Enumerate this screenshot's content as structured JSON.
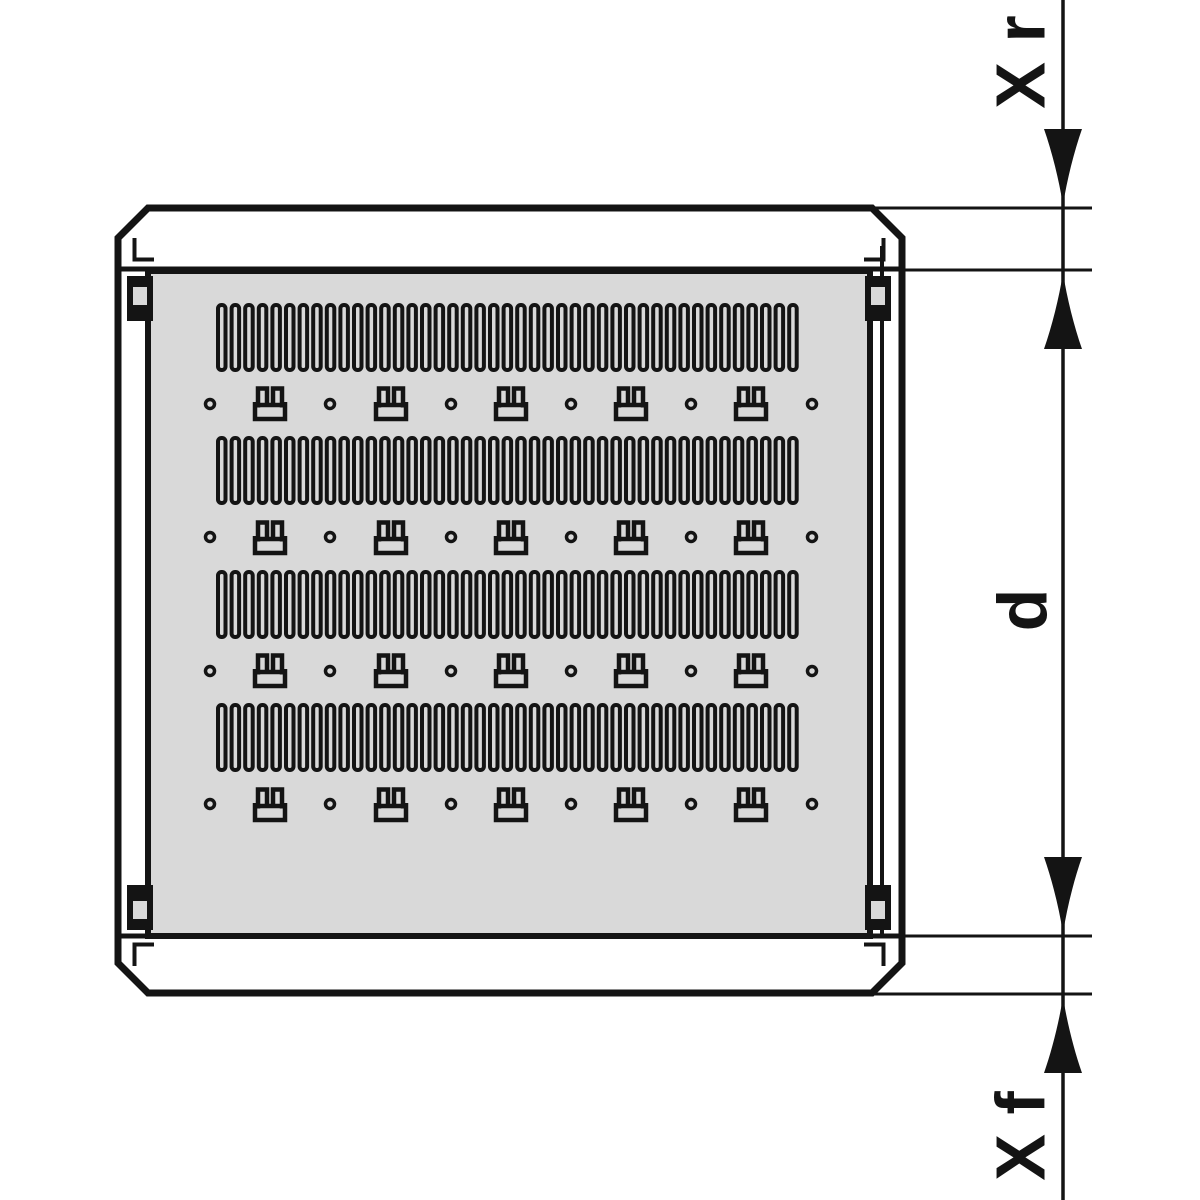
{
  "meta": {
    "background": "#ffffff",
    "line_color": "#141414",
    "panel_fill": "#d9d9d9",
    "white": "#ffffff"
  },
  "canvas": {
    "w": 1200,
    "h": 1200
  },
  "shelf": {
    "frame": {
      "path": "M148,208 H872 L902,238 V963 L872,993 H148 L118,963 V238 Z",
      "stroke_w": 7
    },
    "panel": {
      "x": 148,
      "y": 271,
      "w": 722,
      "h": 665,
      "stroke_w": 6
    },
    "rail_lines": [
      {
        "x1": 118,
        "y1": 269,
        "x2": 902,
        "y2": 269,
        "w": 5
      },
      {
        "x1": 118,
        "y1": 936,
        "x2": 902,
        "y2": 936,
        "w": 5
      },
      {
        "x1": 882,
        "y1": 246,
        "x2": 882,
        "y2": 938,
        "w": 4
      }
    ],
    "corner_steps": [
      "M134.5,238 V259.5 H154",
      "M883.5,238 V259.5 H864",
      "M134.5,966 V944.5 H154",
      "M883.5,966 V944.5 H864"
    ],
    "slot_bands": {
      "tops": [
        305,
        438,
        572,
        705
      ],
      "height": 65,
      "x_start": 218,
      "count": 43,
      "slot_w": 7.5,
      "pitch": 13.6,
      "rx": 3.5,
      "stroke_w": 4
    },
    "clip_rows": {
      "tops": [
        386,
        520,
        653,
        787
      ],
      "centers_x": [
        270,
        391,
        511,
        631,
        751
      ],
      "w": 36,
      "h": 36,
      "stroke_w": 4.5,
      "paths": [
        "M3,16 V33 H33 V16",
        "M6,21.5 V2.5 H15 V19",
        "M21,19 V2.5 H30 V21.5",
        "M4,19 H32"
      ]
    },
    "dot_rows": {
      "centers_y": [
        404,
        537,
        671,
        804
      ],
      "centers_x": [
        210,
        330,
        451,
        571,
        691,
        812
      ],
      "r": 4.5,
      "stroke_w": 3.5
    },
    "hooks": {
      "w": 26,
      "h": 45,
      "window": {
        "x": 6,
        "y": 11,
        "w": 14,
        "h": 18
      },
      "positions": [
        {
          "x": 127,
          "y": 276,
          "fy": 0
        },
        {
          "x": 865,
          "y": 276,
          "fy": 0
        },
        {
          "x": 127,
          "y": 885,
          "fy": 1
        },
        {
          "x": 865,
          "y": 885,
          "fy": 1
        }
      ]
    }
  },
  "dimensions": {
    "axis_x": 1063,
    "line_w": 3,
    "ext_lines": [
      {
        "y": 208,
        "x1": 872,
        "x2": 1092
      },
      {
        "y": 270,
        "x1": 903,
        "x2": 1092
      },
      {
        "y": 936,
        "x1": 903,
        "x2": 1092
      },
      {
        "y": 994,
        "x1": 872,
        "x2": 1092
      }
    ],
    "arrows": [
      {
        "tip_y": 205,
        "dir": "down"
      },
      {
        "tip_y": 273,
        "dir": "up"
      },
      {
        "tip_y": 933,
        "dir": "down"
      },
      {
        "tip_y": 997,
        "dir": "up"
      }
    ],
    "arrow_len": 76,
    "arrow_half_w": 19,
    "font_size": 70,
    "labels": [
      {
        "text": "X r",
        "cx": 1020,
        "cy": 62
      },
      {
        "text": "d",
        "cx": 1022,
        "cy": 610
      },
      {
        "text": "X f",
        "cx": 1020,
        "cy": 1136
      }
    ]
  }
}
